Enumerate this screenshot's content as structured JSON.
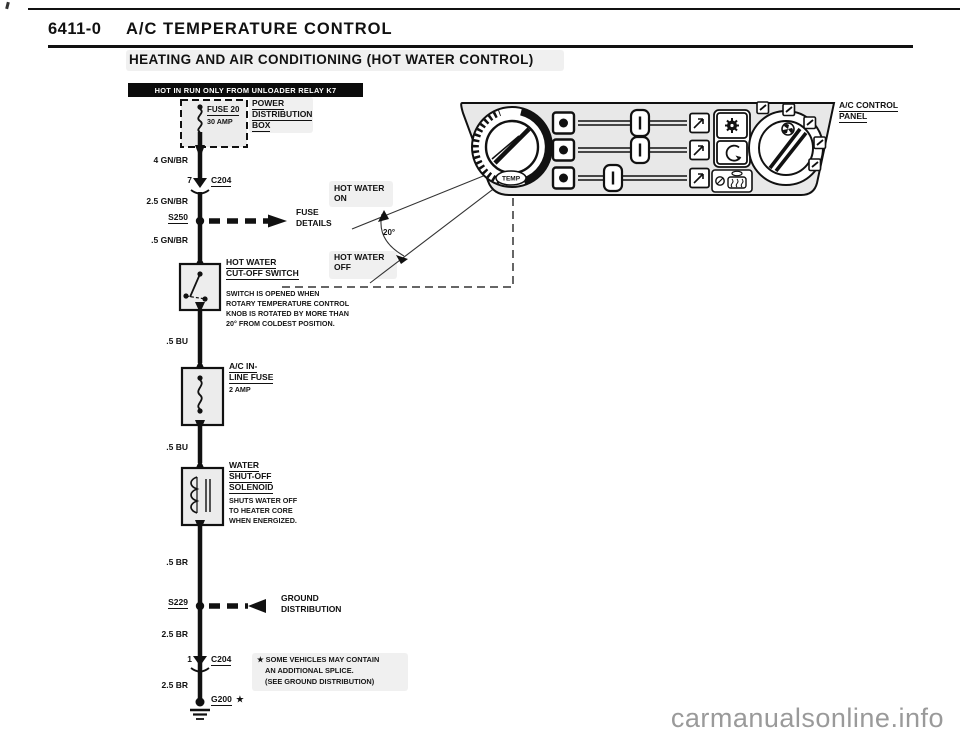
{
  "page": {
    "doc_number": "6411-0",
    "doc_title": "A/C TEMPERATURE CONTROL",
    "section_title": "HEATING AND AIR CONDITIONING (HOT WATER CONTROL)",
    "power_badge": "HOT IN RUN ONLY FROM UNLOADER RELAY K7",
    "watermark": "carmanualsonline.info"
  },
  "schematic": {
    "fuse20": {
      "name": "FUSE 20",
      "rating": "30 AMP"
    },
    "power_box": {
      "line1": "POWER",
      "line2": "DISTRIBUTION",
      "line3": "BOX"
    },
    "wire_labels": {
      "w1": "4 GN/BR",
      "w2": "2.5 GN/BR",
      "w3": ".5 GN/BR",
      "w4": ".5 BU",
      "w5": ".5 BU",
      "w6": ".5 BR",
      "w7": "2.5 BR",
      "w8": "2.5 BR"
    },
    "connector_top": {
      "pin": "7",
      "name": "C204"
    },
    "connector_bottom": {
      "pin": "1",
      "name": "C204"
    },
    "splice_s250": {
      "name": "S250",
      "ref_line1": "FUSE",
      "ref_line2": "DETAILS"
    },
    "splice_s229": {
      "name": "S229",
      "ref_line1": "GROUND",
      "ref_line2": "DISTRIBUTION"
    },
    "cutoff_switch": {
      "title_line1": "HOT WATER",
      "title_line2": "CUT-OFF SWITCH",
      "note_line1": "SWITCH IS OPENED WHEN",
      "note_line2": "ROTARY TEMPERATURE CONTROL",
      "note_line3": "KNOB IS ROTATED BY MORE THAN",
      "note_line4": "20° FROM COLDEST POSITION."
    },
    "inline_fuse": {
      "title_line1": "A/C IN-",
      "title_line2": "LINE FUSE",
      "rating": "2 AMP"
    },
    "solenoid": {
      "title_line1": "WATER",
      "title_line2": "SHUT-OFF",
      "title_line3": "SOLENOID",
      "note_line1": "SHUTS WATER OFF",
      "note_line2": "TO HEATER CORE",
      "note_line3": "WHEN ENERGIZED."
    },
    "ground": {
      "name": "G200",
      "star": "★"
    },
    "star_note": {
      "line1": "★ SOME VEHICLES MAY CONTAIN",
      "line2": "AN ADDITIONAL SPLICE.",
      "line3": "(SEE GROUND DISTRIBUTION)"
    }
  },
  "panel": {
    "label_line1": "A/C CONTROL",
    "label_line2": "PANEL",
    "temp_knob_label": "TEMP",
    "hot_water_on_line1": "HOT WATER",
    "hot_water_on_line2": "ON",
    "hot_water_off_line1": "HOT WATER",
    "hot_water_off_line2": "OFF",
    "angle_label": "20°"
  },
  "colors": {
    "ink": "#111111",
    "panel_shade": "#e8e8e8",
    "watermark_gray": "#9a9a9a"
  }
}
